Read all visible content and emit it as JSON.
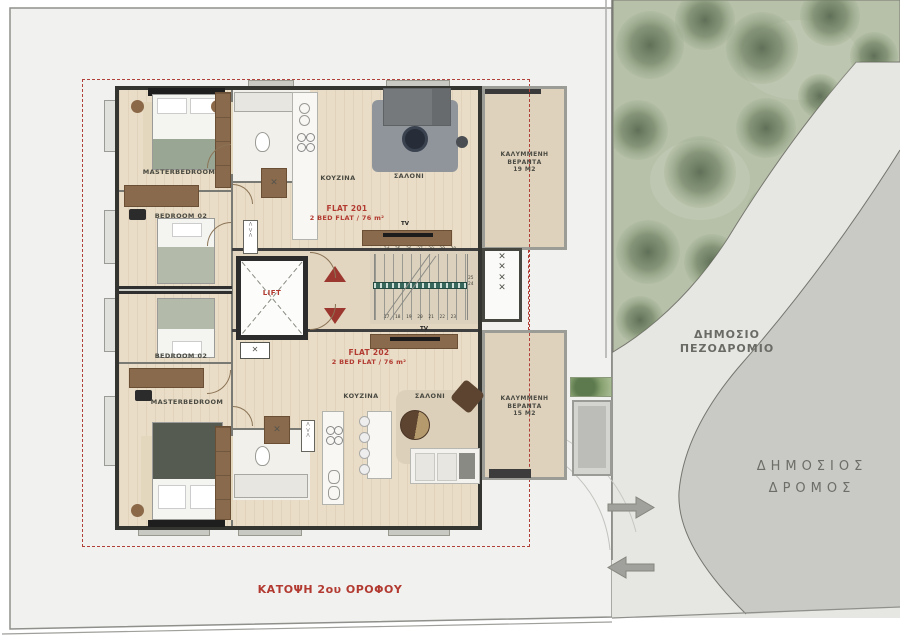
{
  "title": "ΚΑΤΟΨΗ 2ου ΟΡΟΦΟΥ",
  "flats": {
    "flat201": {
      "name": "FLAT 201",
      "spec": "2 BED FLAT / 76 m²",
      "master": "MASTERBEDROOM",
      "bedroom2": "BEDROOM 02",
      "kitchen": "KOYZINA",
      "living": "ΣΑΛΟΝΙ",
      "tv": "TV",
      "veranda": {
        "line1": "ΚΑΛΥΜΜΕΝΗ",
        "line2": "ΒΕΡΑΝΤΑ",
        "line3": "19 M2"
      }
    },
    "flat202": {
      "name": "FLAT 202",
      "spec": "2 BED FLAT / 76 m²",
      "master": "MASTERBEDROOM",
      "bedroom2": "BEDROOM 02",
      "kitchen": "KOYZINA",
      "living": "ΣΑΛΟΝΙ",
      "tv": "TV",
      "veranda": {
        "line1": "ΚΑΛΥΜΜΕΝΗ",
        "line2": "ΒΕΡΑΝΤΑ",
        "line3": "15 M2"
      }
    }
  },
  "core": {
    "lift": "LIFT",
    "stairs": {
      "top_numbers": "24 25 26 27 28 29 30",
      "bottom_numbers": "17 18 19 20 21 22 23",
      "rail_upper": "25",
      "rail_lower": "24"
    }
  },
  "site": {
    "sidewalk_line1": "ΔΗΜΟΣΙΟ",
    "sidewalk_line2": "ΠΕΖΟΔΡΟΜΙΟ",
    "road_line1": "ΔΗΜΟΣΙΟΣ",
    "road_line2": "ΔΡΟΜΟΣ"
  },
  "colors": {
    "accent_red": "#b23a31",
    "park_green": "#b7c1aa",
    "sidewalk_gray": "#e6e6e3",
    "road_gray": "#c9c9c6",
    "wall_dark": "#3f3f3f",
    "wood_brown": "#8a6a4c"
  }
}
